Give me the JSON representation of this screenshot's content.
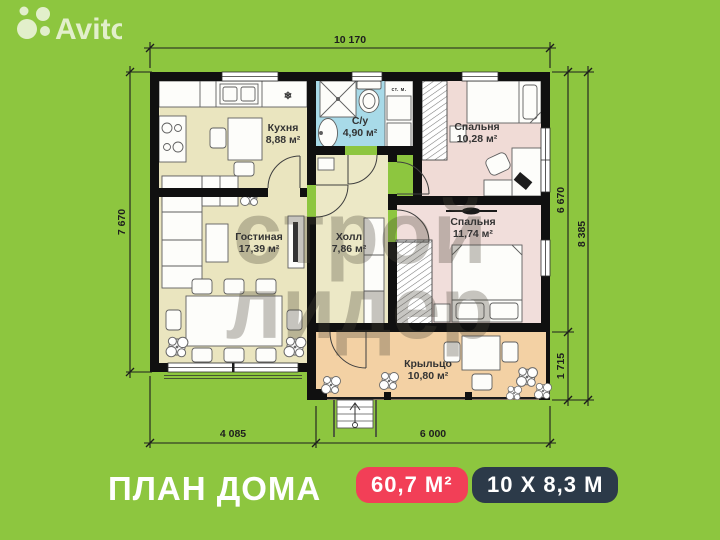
{
  "header": {
    "title": "ПЛАН ДОМА",
    "area_badge": "60,7 М²",
    "size_badge": "10 Х 8,3 М"
  },
  "watermark": {
    "line1": "строй",
    "line2": "лидер"
  },
  "brand": {
    "name": "Avito"
  },
  "plan": {
    "rooms": [
      {
        "id": "kitchen",
        "name": "Кухня",
        "area": "8,88 м²"
      },
      {
        "id": "bathroom",
        "name": "С/у",
        "area": "4,90 м²"
      },
      {
        "id": "bedroom1",
        "name": "Спальня",
        "area": "10,28 м²"
      },
      {
        "id": "living",
        "name": "Гостиная",
        "area": "17,39 м²"
      },
      {
        "id": "hall",
        "name": "Холл",
        "area": "7,86 м²"
      },
      {
        "id": "bedroom2",
        "name": "Спальня",
        "area": "11,74 м²"
      },
      {
        "id": "porch",
        "name": "Крыльцо",
        "area": "10,80 м²"
      }
    ],
    "annotations": {
      "washing_machine": "ст. м.",
      "fridge_icon": "❄"
    },
    "dimensions": {
      "width_total": "10 170",
      "left_height": "7 670",
      "right_upper": "6 670",
      "right_lower": "1 715",
      "right_total": "8 385",
      "bottom_left": "4 085",
      "bottom_right": "6 000"
    },
    "colors": {
      "background": "#8dc63f",
      "wall": "#101010",
      "room_common": "#eae5bf",
      "room_bedroom": "#f0dbd6",
      "room_bath": "#a8dae8",
      "room_porch": "#f3d1a4",
      "badge_area": "#f23f57",
      "badge_size": "#2c3a49",
      "watermark": "#4a4538"
    }
  }
}
